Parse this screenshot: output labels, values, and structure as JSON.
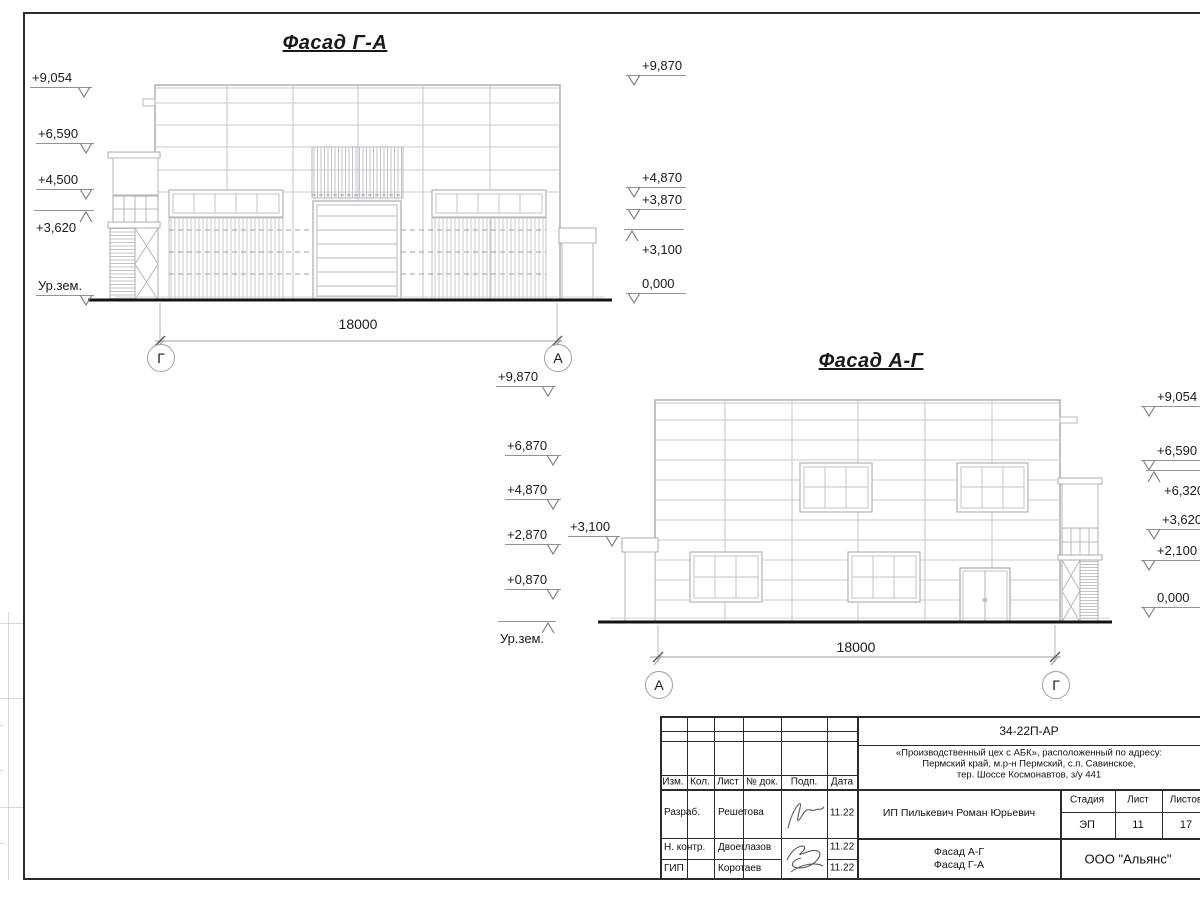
{
  "facade1": {
    "title": "Фасад Г-А",
    "dimension": "18000",
    "axis_left": "Г",
    "axis_right": "А",
    "marks_left": [
      {
        "label": "+9,054",
        "dir": "down"
      },
      {
        "label": "+6,590",
        "dir": "down"
      },
      {
        "label": "+4,500",
        "dir": "down"
      },
      {
        "label": "+3,620",
        "dir": "up"
      },
      {
        "label": "Ур.зем.",
        "dir": "down"
      }
    ],
    "marks_right": [
      {
        "label": "+9,870",
        "dir": "down"
      },
      {
        "label": "+4,870",
        "dir": "down"
      },
      {
        "label": "+3,870",
        "dir": "down"
      },
      {
        "label": "+3,100",
        "dir": "up"
      },
      {
        "label": "0,000",
        "dir": "down"
      }
    ]
  },
  "facade2": {
    "title": "Фасад А-Г",
    "dimension": "18000",
    "axis_left": "А",
    "axis_right": "Г",
    "marks_left": [
      {
        "label": "+9,870",
        "dir": "down"
      },
      {
        "label": "+6,870",
        "dir": "down"
      },
      {
        "label": "+4,870",
        "dir": "down"
      },
      {
        "label": "+2,870",
        "dir": "down"
      },
      {
        "label": "+0,870",
        "dir": "down"
      },
      {
        "label": "Ур.зем.",
        "dir": "up"
      },
      {
        "label": "+3,100",
        "dir": "down"
      }
    ],
    "marks_right": [
      {
        "label": "+9,054",
        "dir": "down"
      },
      {
        "label": "+6,590",
        "dir": "down"
      },
      {
        "label": "+6,320",
        "dir": "up"
      },
      {
        "label": "+3,620",
        "dir": "down"
      },
      {
        "label": "+2,100",
        "dir": "down"
      },
      {
        "label": "0,000",
        "dir": "down"
      }
    ]
  },
  "titleblock": {
    "doc_number": "34-22П-АР",
    "project_line1": "«Производственный цех с АБК», расположенный по адресу:",
    "project_line2": "Пермский край, м.р-н Пермский, с.п. Савинское,",
    "project_line3": "тер. Шоссе Космонавтов, з/у 441",
    "header": {
      "izm": "Изм.",
      "kol": "Кол.",
      "list": "Лист",
      "doc": "№ док.",
      "podp": "Подп.",
      "data": "Дата"
    },
    "rows": [
      {
        "role": "Разраб.",
        "name": "Решетова",
        "date": "11.22"
      },
      {
        "role": "Н. контр.",
        "name": "Двоеглазов",
        "date": "11.22"
      },
      {
        "role": "ГИП",
        "name": "Коротаев",
        "date": "11.22"
      }
    ],
    "client": "ИП Пилькевич Роман Юрьевич",
    "stage_label": "Стадия",
    "sheet_label": "Лист",
    "sheets_label": "Листов",
    "stage": "ЭП",
    "sheet_no": "11",
    "sheets_total": "17",
    "sheet_title_line1": "Фасад А-Г",
    "sheet_title_line2": "Фасад Г-А",
    "company": "ООО \"Альянс\""
  }
}
